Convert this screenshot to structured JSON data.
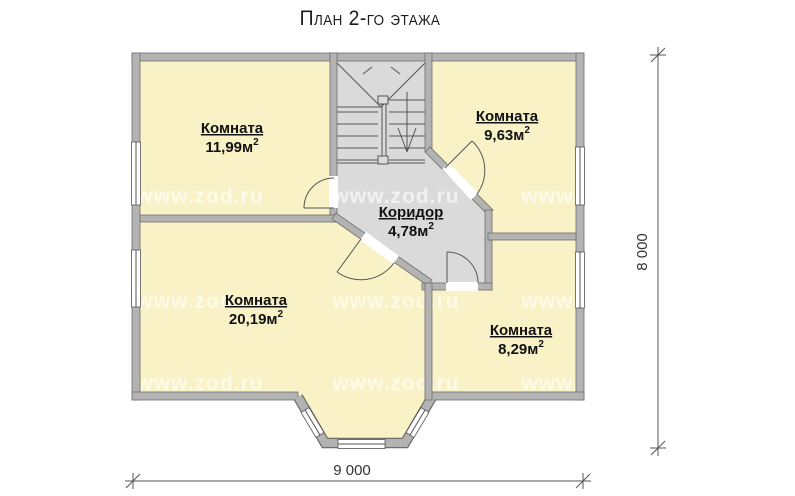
{
  "title": "План 2-го этажа",
  "watermark_text": "www.zod.ru",
  "plan": {
    "rooms": [
      {
        "id": "room-top-left",
        "name": "Комната",
        "area": "11,99м",
        "exp": "2"
      },
      {
        "id": "room-top-right",
        "name": "Комната",
        "area": "9,63м",
        "exp": "2"
      },
      {
        "id": "corridor",
        "name": "Коридор",
        "area": "4,78м",
        "exp": "2"
      },
      {
        "id": "room-bottom-left",
        "name": "Комната",
        "area": "20,19м",
        "exp": "2"
      },
      {
        "id": "room-bottom-right",
        "name": "Комната",
        "area": "8,29м",
        "exp": "2"
      }
    ],
    "dimensions": {
      "horizontal": "9 000",
      "vertical": "8 000"
    },
    "colors": {
      "room_fill": "#f8f2c6",
      "hall_fill": "#dadada",
      "wall_fill": "#b3b3b3",
      "wall_edge": "#6e6e6e",
      "line": "#555555"
    }
  }
}
